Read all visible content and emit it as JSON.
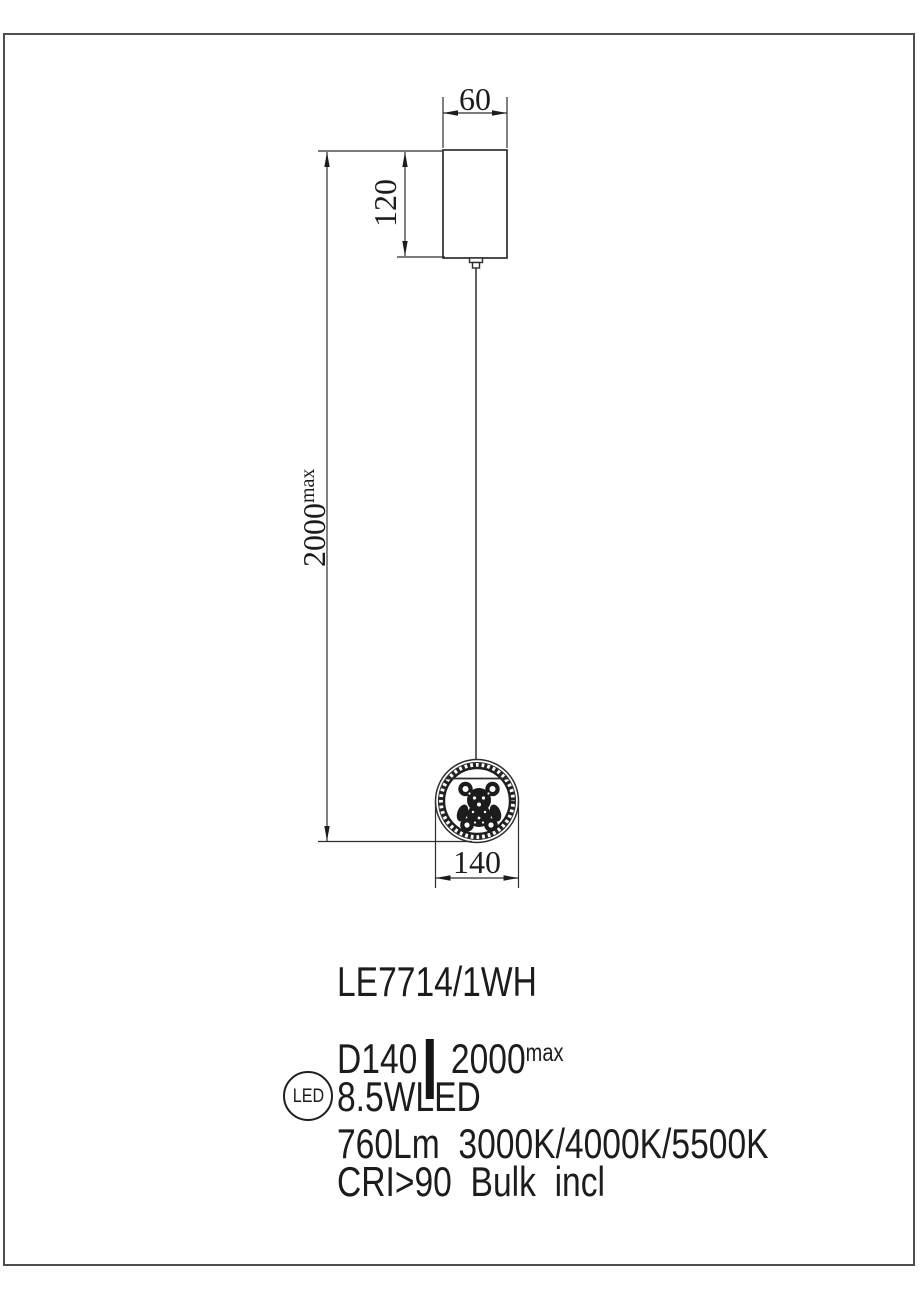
{
  "page": {
    "background": "#ffffff",
    "border_color": "#4f4f4f",
    "ink_color": "#1c1c1c",
    "line_color": "#2e2e2e"
  },
  "dimensions": {
    "canopy_width": "60",
    "canopy_height": "120",
    "suspension_drop": "2000",
    "suspension_drop_sup": "max",
    "pendant_diameter": "140"
  },
  "specs": {
    "model": "LE7714/1WH",
    "diameter": "D140",
    "drop": "2000",
    "drop_sup": "max",
    "led_badge": "LED",
    "power": "8.5WLED",
    "lumens_color_temp": "760Lm  3000K/4000K/5500K",
    "cri_bulb": "CRI>90  Bulk  incl"
  }
}
